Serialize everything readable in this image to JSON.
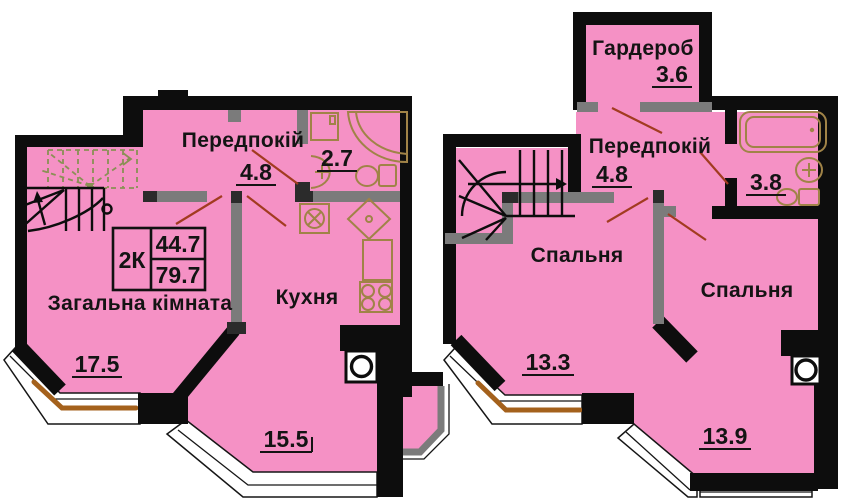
{
  "floor1": {
    "hallway_name": "Передпокій",
    "hallway_area": "4.8",
    "bath_area": "2.7",
    "living_name": "Загальна кімната",
    "living_area": "17.5",
    "kitchen_name": "Кухня",
    "kitchen_area": "15.5",
    "stamp_type": "2К",
    "stamp_living_area": "44.7",
    "stamp_total_area": "79.7"
  },
  "floor2": {
    "wardrobe_name": "Гардероб",
    "wardrobe_area": "3.6",
    "hallway_name": "Передпокій",
    "hallway_area": "4.8",
    "bath_area": "3.8",
    "bedroom1_name": "Спальня",
    "bedroom1_area": "13.3",
    "bedroom2_name": "Спальня",
    "bedroom2_area": "13.9"
  },
  "colors": {
    "room_fill": "#F591C5",
    "wall": "#0d0d0d",
    "partition": "#7b7b7b",
    "leader": "#A23B20",
    "window_frame": "#A4611C",
    "fixture": "#A08347",
    "stairs_dash": "#8A9055",
    "text": "#141414"
  }
}
